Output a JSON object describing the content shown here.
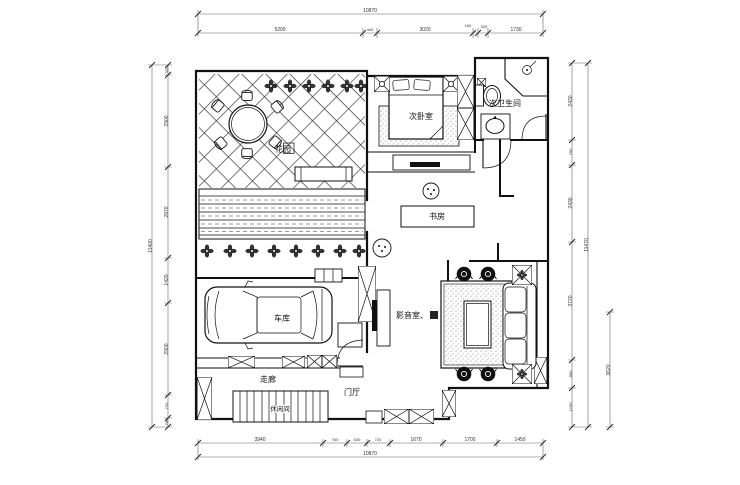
{
  "rooms": {
    "garden": "花园",
    "bedroom": "次卧室",
    "bathroom": "次卫生间",
    "study": "书房",
    "garage": "车库",
    "media_room": "影音室、",
    "corridor": "走廊",
    "foyer": "门厅",
    "stair_room": "休闲间"
  },
  "dims": {
    "top_overall": "10870",
    "top_segments": [
      "5200",
      "440",
      "3020",
      "160",
      "320",
      "1730"
    ],
    "bottom_overall": "10870",
    "bottom_segments": [
      "3940",
      "760",
      "630",
      "720",
      "1670",
      "1700",
      "1450"
    ],
    "left_overall": "11400",
    "left_segments": [
      "320",
      "2900",
      "2870",
      "1420",
      "2900",
      "720",
      "280"
    ],
    "right_overall": "11470",
    "right_segments": [
      "2430",
      "790",
      "2430",
      "3720",
      "880",
      "1230"
    ],
    "right_aux": "3620"
  },
  "icons": {
    "flower-icon": "✣",
    "shower-icon": "⚘",
    "window-icon": "⊠",
    "column-icon": "▣"
  },
  "colors": {
    "line": "#111111",
    "dim_line": "#666666",
    "dim_text": "#333333",
    "paper": "#ffffff",
    "stipple": "#888888"
  }
}
